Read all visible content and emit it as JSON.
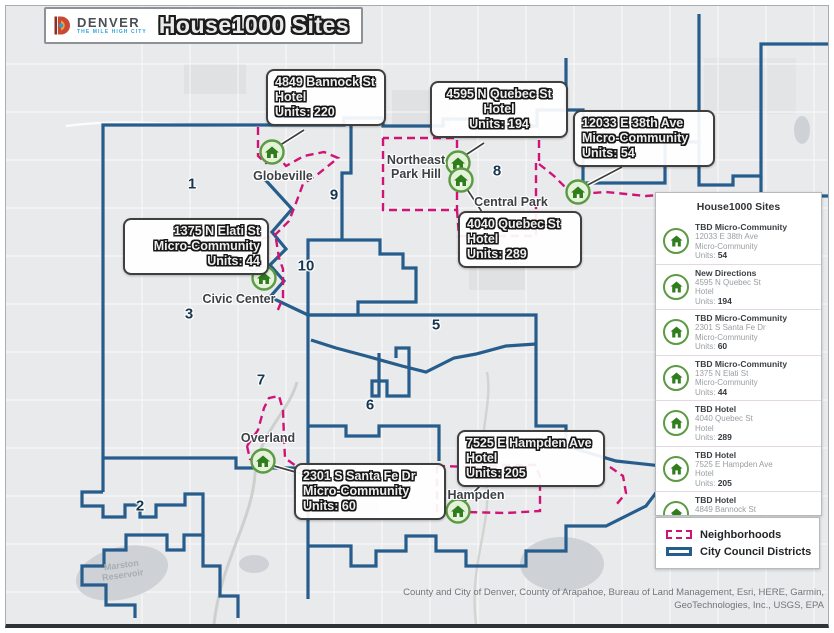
{
  "header": {
    "logo_name": "DENVER",
    "logo_tagline": "THE MILE HIGH CITY",
    "title": "House1000 Sites"
  },
  "map": {
    "district_labels": [
      {
        "n": "1",
        "x": 186,
        "y": 178
      },
      {
        "n": "9",
        "x": 328,
        "y": 189
      },
      {
        "n": "8",
        "x": 491,
        "y": 165
      },
      {
        "n": "10",
        "x": 300,
        "y": 260
      },
      {
        "n": "3",
        "x": 183,
        "y": 308
      },
      {
        "n": "5",
        "x": 430,
        "y": 319
      },
      {
        "n": "7",
        "x": 255,
        "y": 374
      },
      {
        "n": "6",
        "x": 364,
        "y": 399
      },
      {
        "n": "2",
        "x": 134,
        "y": 500
      }
    ],
    "neighborhood_labels": [
      {
        "id": "globeville",
        "t": "Globeville",
        "x": 277,
        "y": 170
      },
      {
        "id": "northeast-park-hill",
        "t": "Northeast\nPark Hill",
        "x": 410,
        "y": 161
      },
      {
        "id": "central-park",
        "t": "Central Park",
        "x": 505,
        "y": 196
      },
      {
        "id": "civic-center",
        "t": "Civic Center",
        "x": 233,
        "y": 293
      },
      {
        "id": "overland",
        "t": "Overland",
        "x": 262,
        "y": 432
      },
      {
        "id": "hampden",
        "t": "Hampden",
        "x": 470,
        "y": 489
      }
    ],
    "water_label": {
      "t": "Marston\nReservoir",
      "x": 116,
      "y": 564
    },
    "callouts": [
      {
        "id": "bannock-4849",
        "x": 260,
        "y": 63,
        "w": 102,
        "align": "left",
        "lines": [
          "4849 Bannock St",
          "Hotel",
          "Units: 220"
        ]
      },
      {
        "id": "quebec-4595",
        "x": 424,
        "y": 75,
        "w": 120,
        "align": "center",
        "lines": [
          "4595 N Quebec St",
          "Hotel",
          "Units: 194"
        ]
      },
      {
        "id": "38th-ave-12033",
        "x": 567,
        "y": 104,
        "w": 124,
        "align": "left",
        "lines": [
          "12033 E 38th Ave",
          "Micro-Community",
          "Units: 54"
        ]
      },
      {
        "id": "quebec-4040",
        "x": 452,
        "y": 205,
        "w": 106,
        "align": "left",
        "lines": [
          "4040 Quebec St",
          "Hotel",
          "Units: 289"
        ]
      },
      {
        "id": "elati-1375",
        "x": 117,
        "y": 212,
        "w": 128,
        "align": "right",
        "lines": [
          "1375 N Elati St",
          "Micro-Community",
          "Units: 44"
        ]
      },
      {
        "id": "santa-fe-2301",
        "x": 288,
        "y": 457,
        "w": 134,
        "align": "left",
        "lines": [
          "2301 S Santa Fe Dr",
          "Micro-Community",
          "Units: 60"
        ]
      },
      {
        "id": "hampden-7525",
        "x": 451,
        "y": 424,
        "w": 130,
        "align": "left",
        "lines": [
          "7525 E Hampden Ave",
          "Hotel",
          "Units: 205"
        ]
      }
    ],
    "markers": [
      {
        "id": "bannock-4849",
        "x": 266,
        "y": 146
      },
      {
        "id": "quebec-4595",
        "x": 452,
        "y": 157
      },
      {
        "id": "quebec-4040",
        "x": 455,
        "y": 174
      },
      {
        "id": "38th-ave-12033",
        "x": 572,
        "y": 186
      },
      {
        "id": "elati-1375",
        "x": 258,
        "y": 272
      },
      {
        "id": "santa-fe-2301",
        "x": 257,
        "y": 455
      },
      {
        "id": "hampden-7525",
        "x": 452,
        "y": 505
      }
    ],
    "leaders": [
      {
        "x1": 268,
        "y1": 143,
        "x2": 298,
        "y2": 124
      },
      {
        "x1": 452,
        "y1": 154,
        "x2": 478,
        "y2": 137
      },
      {
        "x1": 457,
        "y1": 177,
        "x2": 476,
        "y2": 206
      },
      {
        "x1": 574,
        "y1": 183,
        "x2": 616,
        "y2": 161
      },
      {
        "x1": 255,
        "y1": 269,
        "x2": 243,
        "y2": 263
      },
      {
        "x1": 261,
        "y1": 458,
        "x2": 300,
        "y2": 469
      },
      {
        "x1": 453,
        "y1": 501,
        "x2": 474,
        "y2": 480
      }
    ]
  },
  "sidebar": {
    "title": "House1000 Sites",
    "units_label": "Units:",
    "items": [
      {
        "name": "TBD Micro-Community",
        "address": "12033 E 38th Ave",
        "type": "Micro-Community",
        "units": "54"
      },
      {
        "name": "New Directions",
        "address": "4595 N Quebec St",
        "type": "Hotel",
        "units": "194"
      },
      {
        "name": "TBD Micro-Community",
        "address": "2301 S Santa Fe Dr",
        "type": "Micro-Community",
        "units": "60"
      },
      {
        "name": "TBD Micro-Community",
        "address": "1375 N Elati St",
        "type": "Micro-Community",
        "units": "44"
      },
      {
        "name": "TBD Hotel",
        "address": "4040 Quebec St",
        "type": "Hotel",
        "units": "289"
      },
      {
        "name": "TBD Hotel",
        "address": "7525 E Hampden Ave",
        "type": "Hotel",
        "units": "205"
      },
      {
        "name": "TBD Hotel",
        "address": "4849 Bannock St",
        "type": "Hotel",
        "units": "220"
      }
    ]
  },
  "legend": {
    "items": [
      {
        "label": "Neighborhoods",
        "style": "dashed-pink"
      },
      {
        "label": "City Council Districts",
        "style": "solid-blue"
      }
    ]
  },
  "attribution": {
    "line1": "County and City of Denver, County of Arapahoe, Bureau of Land Management, Esri, HERE, Garmin,",
    "line2": "GeoTechnologies, Inc., USGS, EPA"
  },
  "colors": {
    "district_boundary": "#275d8c",
    "neighborhood_boundary": "#d01377",
    "marker_green": "#2f7d1c",
    "map_background": "#e9eaeb"
  }
}
